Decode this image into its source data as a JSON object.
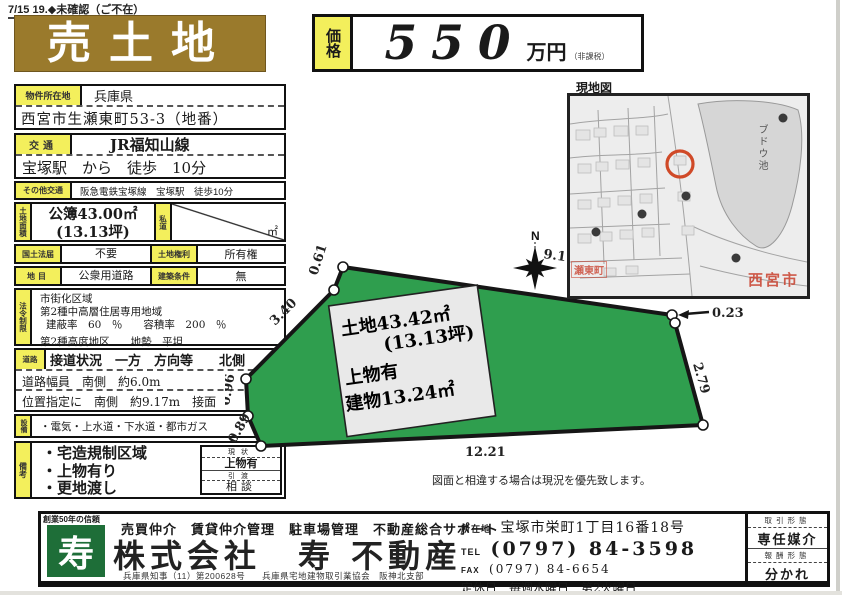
{
  "colors": {
    "title_brown": "#9a7a2c",
    "label_yellow": "#f3ef5c",
    "plot_green": "#2f9e4e",
    "logo_green": "#1e6e38",
    "map_red": "#c8402d"
  },
  "header": {
    "note": "7/15 19.◆未確認（ご不在）",
    "title": "売土地",
    "price_label": "価格",
    "price_amount": "550",
    "price_unit": "万円",
    "price_tax": "（非課税）"
  },
  "table": {
    "location_label": "物件所在地",
    "pref": "兵庫県",
    "address": "西宮市生瀬東町53-3（地番）",
    "transport_label": "交通",
    "line": "JR福知山線",
    "station": "宝塚駅　から　徒歩　10分",
    "other_transport_label": "その他交通",
    "other_transport": "阪急電鉄宝塚線　宝塚駅　徒歩10分",
    "area_label": "土地面積",
    "area_value": "公簿43.00㎡",
    "area_tsubo": "(13.13坪)",
    "private_road_label": "私道",
    "private_road_unit": "㎡",
    "kokudo_label": "国土法届",
    "kokudo_value": "不要",
    "rights_label": "土地権利",
    "rights_value": "所有権",
    "chimoku_label": "地目",
    "chimoku_value": "公衆用道路",
    "jouken_label": "建築条件",
    "jouken_value": "無",
    "houki_label": "法令制限",
    "houki_1": "市街化区域",
    "houki_2": "第2種中高層住居専用地域",
    "houki_3": "建蔽率　60　％　　容積率　200　％",
    "houki_4": "第2種高度地区　　地勢　平坦",
    "road_label": "道路",
    "road_1": "接道状況　一方　方向等　　北側",
    "road_2": "道路幅員　南側　約6.0m",
    "road_3": "位置指定に　南側　約9.17m　接面",
    "setsubi_label": "設備",
    "setsubi": "・電気・上水道・下水道・都市ガス",
    "bikou_label": "備考",
    "bikou_1": "・宅造規制区域",
    "bikou_2": "・上物有り",
    "bikou_3": "・更地渡し",
    "genjo_label": "現状",
    "genjo_value": "上物有",
    "hikiwatashi_label": "引渡",
    "hikiwatashi_value": "相談"
  },
  "plot": {
    "land_area": "土地43.42㎡",
    "land_tsubo": "(13.13坪)",
    "building_note": "上物有",
    "building_area": "建物13.24㎡",
    "m_top": "9.17",
    "m_top_left": "0.61",
    "m_left_diag": "3.40",
    "m_left_1": "0.96",
    "m_left_2": "0.89",
    "m_bottom": "12.21",
    "m_right": "2.79",
    "m_top_right": "0.23",
    "compass": "N",
    "disclaimer": "図面と相違する場合は現況を優先致します。"
  },
  "map": {
    "title": "現地図",
    "pond": "ブドウ池",
    "city": "西宮市",
    "town": "瀬東町"
  },
  "footer": {
    "tagline": "創業50年の信頼",
    "logo": "寿",
    "services": "売買仲介　賃貸仲介管理　駐車場管理　不動産総合サポート",
    "company": "株式会社　寿 不動産",
    "license_1": "兵庫県知事（11）第200628号",
    "license_2": "兵庫県宅地建物取引業協会　阪神北支部",
    "addr_label": "所在地",
    "addr": "宝塚市栄町1丁目16番18号",
    "tel_label": "TEL",
    "tel": "(0797) 84-3598",
    "fax_label": "FAX",
    "fax": "(0797) 84-6654",
    "holiday": "定休日　毎週水曜日　第2火曜日",
    "deal_label": "取引形態",
    "deal": "専任媒介",
    "fee_label": "報酬形態",
    "fee": "分かれ"
  }
}
